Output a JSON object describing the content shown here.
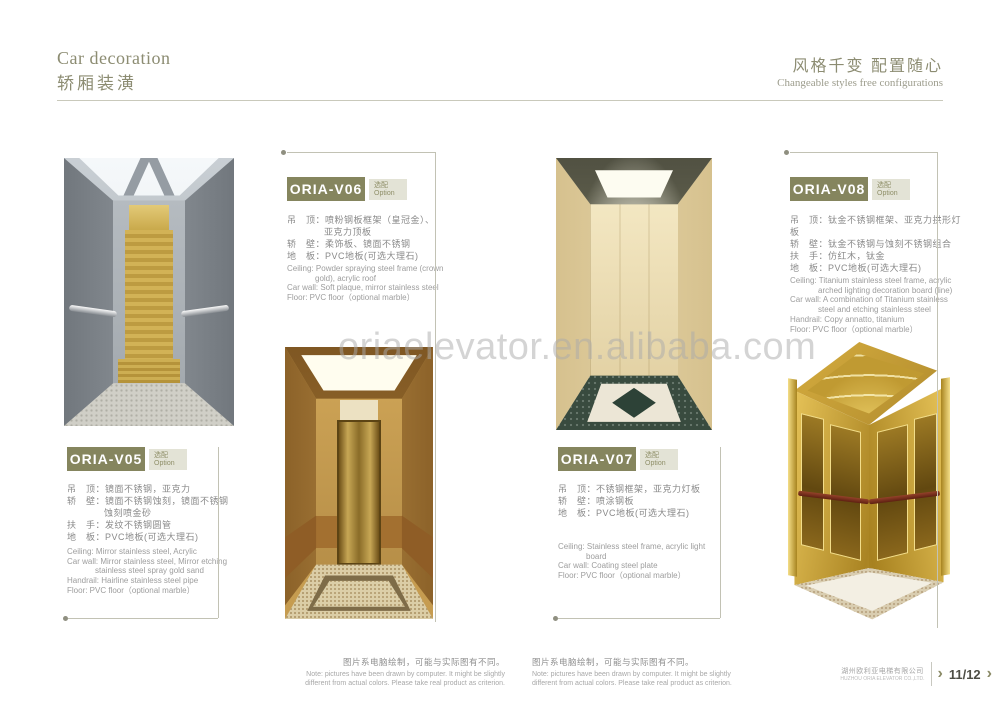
{
  "header": {
    "title_en": "Car decoration",
    "title_zh": "轿厢装潢",
    "tagline_zh": "风格千变 配置随心",
    "tagline_en": "Changeable styles free configurations"
  },
  "watermark": "oriaelevator.en.alibaba.com",
  "products": [
    {
      "model": "ORIA-V05",
      "option_zh": "选配",
      "option_en": "Option",
      "specs_zh": [
        "吊　顶：镜面不锈钢，亚克力",
        "轿　壁：镜面不锈钢蚀刻，镜面不锈钢",
        "蚀刻喷金砂",
        "扶　手：发纹不锈钢圆管",
        "地　板：PVC地板(可选大理石)"
      ],
      "specs_en": [
        "Ceiling: Mirror stainless steel, Acrylic",
        "Car wall: Mirror stainless steel, Mirror etching",
        "stainless steel spray gold sand",
        "Handrail: Hairline stainless steel pipe",
        "Floor: PVC floor（optional marble）"
      ]
    },
    {
      "model": "ORIA-V06",
      "option_zh": "选配",
      "option_en": "Option",
      "specs_zh": [
        "吊　顶：喷粉钢板框架（皇冠金）、",
        "亚克力顶板",
        "轿　壁：柔饰板、镜面不锈钢",
        "地　板：PVC地板(可选大理石)"
      ],
      "specs_en": [
        "Ceiling: Powder spraying steel frame (crown",
        "gold), acrylic roof",
        "Car wall: Soft plaque, mirror stainless steel",
        "Floor: PVC floor（optional marble）"
      ]
    },
    {
      "model": "ORIA-V07",
      "option_zh": "选配",
      "option_en": "Option",
      "specs_zh": [
        "吊　顶：不锈钢框架，亚克力灯板",
        "轿　壁：喷涂钢板",
        "地　板：PVC地板(可选大理石)"
      ],
      "specs_en": [
        "Ceiling: Stainless steel frame, acrylic light",
        "board",
        "Car wall: Coating steel plate",
        "Floor: PVC floor（optional marble）"
      ]
    },
    {
      "model": "ORIA-V08",
      "option_zh": "选配",
      "option_en": "Option",
      "specs_zh": [
        "吊　顶：钛金不锈钢框架、亚克力拱形灯板",
        "轿　壁：钛金不锈钢与蚀刻不锈钢组合",
        "扶　手：仿红木，钛金",
        "地　板：PVC地板(可选大理石)"
      ],
      "specs_en": [
        "Ceiling: Titanium stainless steel frame, acrylic",
        "arched lighting decoration board (line)",
        "Car wall: A combination of Titanium stainless",
        "steel and etching stainless steel",
        "Handrail: Copy annatto, titanium",
        "Floor: PVC floor（optional marble）"
      ]
    }
  ],
  "note": {
    "zh": "图片系电脑绘制，可能与实际图有不同。",
    "en1": "Note: pictures have been drawn by computer. It might be slightly",
    "en2": "different from actual colors. Please take real product as criterion."
  },
  "footer": {
    "company_zh": "湖州欧利亚电梯有限公司",
    "company_en": "HUZHOU ORIA ELEVATOR CO.,LTD.",
    "page": "11/12",
    "chevron": "›"
  },
  "colors": {
    "accent_olive": "#85855e",
    "option_bg": "#e3e3d6",
    "gold": "#c9a84c",
    "text_gray": "#8d8d8d"
  }
}
